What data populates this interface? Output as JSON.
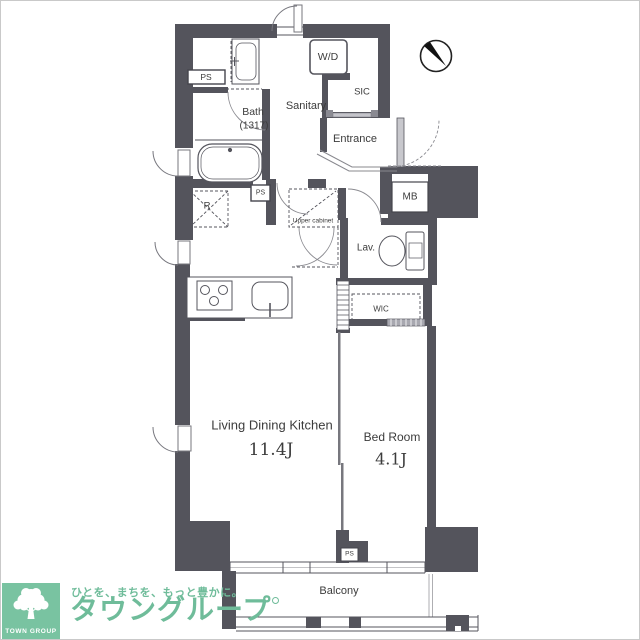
{
  "plan": {
    "colors": {
      "wall": "#54545c",
      "line": "#555555",
      "text": "#3c3c3c"
    },
    "rooms": {
      "bath": {
        "label": "Bath",
        "size": "(1317)"
      },
      "sanitary": {
        "label": "Sanitary"
      },
      "wd": {
        "label": "W/D"
      },
      "sic": {
        "label": "SIC"
      },
      "entrance": {
        "label": "Entrance"
      },
      "mb": {
        "label": "MB"
      },
      "lav": {
        "label": "Lav."
      },
      "wic": {
        "label": "WIC"
      },
      "upper_cabinet": {
        "label": "Upper cabinet"
      },
      "refrigerator": {
        "label": "R"
      },
      "ldk": {
        "label": "Living Dining Kitchen",
        "size": "11.4J"
      },
      "bedroom": {
        "label": "Bed Room",
        "size": "4.1J"
      },
      "balcony": {
        "label": "Balcony"
      },
      "ps_top": {
        "label": "PS"
      },
      "ps_mid": {
        "label": "PS"
      },
      "ps_bottom": {
        "label": "PS"
      }
    }
  },
  "branding": {
    "logo_text": "TOWN GROUP",
    "tagline": "ひとを、まちを、もっと豊かに。",
    "brand_name": "タウングループ",
    "brand_green": "#6fbc9a"
  }
}
